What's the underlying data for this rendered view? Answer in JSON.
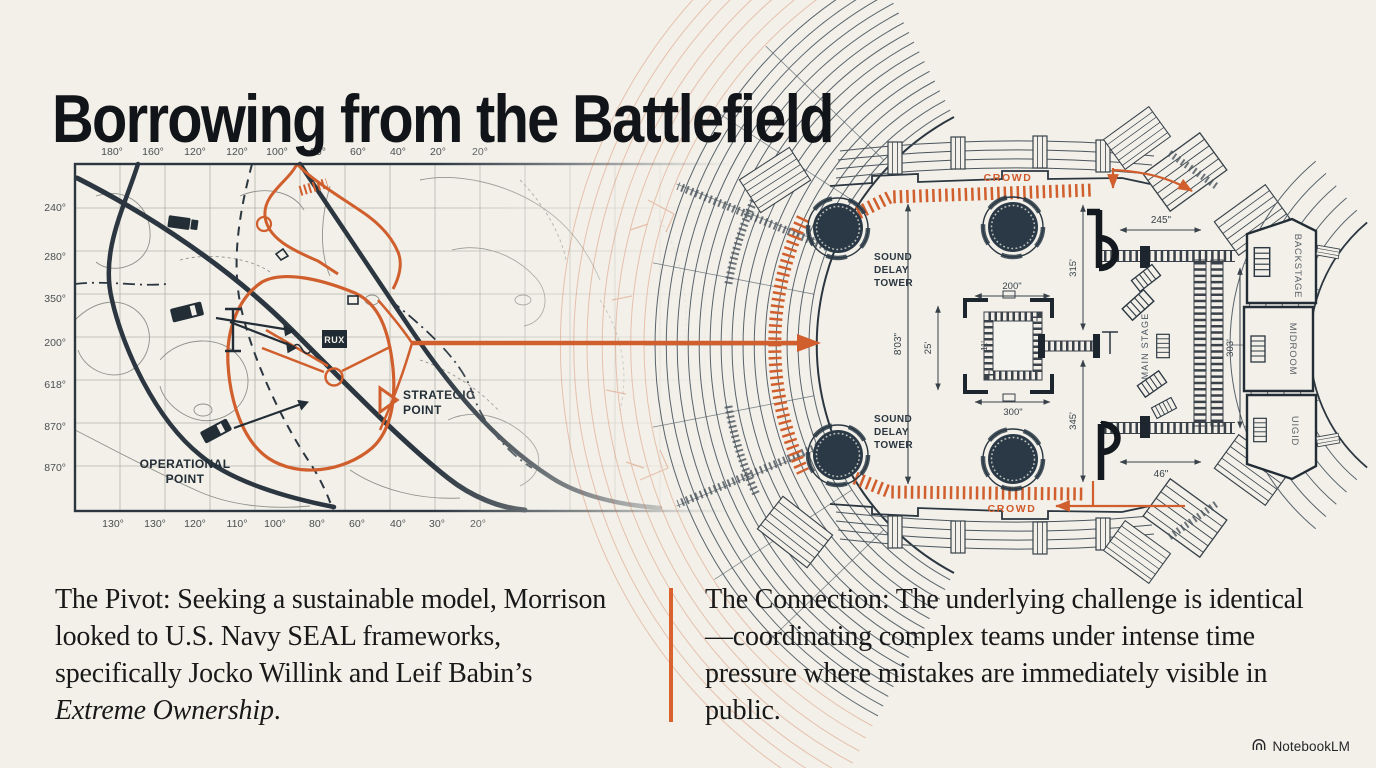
{
  "slide": {
    "title": "Borrowing from the Battlefield",
    "accent_orange": "#d05f2d",
    "ink_dark": "#2b3640",
    "background": "#f2f0e9"
  },
  "map": {
    "axis_top": [
      "180°",
      "160°",
      "120°",
      "120°",
      "100°",
      "80°",
      "60°",
      "40°",
      "20°",
      "20°"
    ],
    "axis_bottom": [
      "130°",
      "130°",
      "120°",
      "110°",
      "100°",
      "80°",
      "60°",
      "40°",
      "30°",
      "20°"
    ],
    "axis_left": [
      "240°",
      "280°",
      "350°",
      "200°",
      "618°",
      "870°",
      "870°"
    ],
    "operational": [
      "OPERATIONAL",
      "POINT"
    ],
    "strategic": [
      "STRATEGIC",
      "POINT"
    ],
    "marker_box": "RUX"
  },
  "plan": {
    "crowd_top": "CROWD",
    "crowd_bottom": "CROWD",
    "tower_top": [
      "SOUND",
      "DELAY",
      "TOWER"
    ],
    "tower_bottom": [
      "SOUND",
      "DELAY",
      "TOWER"
    ],
    "rooms": [
      "BACKSTAGE",
      "MIDROOM",
      "UIGID"
    ],
    "stage_label": "MAIN STAGE",
    "dims": {
      "top_width": "245\"",
      "bottom_width": "46\"",
      "arena_height": "8'03\"",
      "left_upper": "315'",
      "left_lower": "345'",
      "stage_right": "303'",
      "bstage_top": "200\"",
      "bstage_bottom": "300\"",
      "bstage_left": "25'",
      "bstage_inner": "11'"
    }
  },
  "columns": {
    "left": {
      "lead": "The Pivot:",
      "body": " Seeking a sustainable model, Morrison looked to U.S. Navy SEAL frameworks, specifically Jocko Willink and Leif Babin’s ",
      "italic": "Extreme Ownership",
      "tail": "."
    },
    "right": {
      "lead": "The Connection:",
      "body": " The underlying challenge is identical—coordinating complex teams under intense time pressure where mistakes are immediately visible in public."
    }
  },
  "footer": {
    "brand": "NotebookLM"
  }
}
